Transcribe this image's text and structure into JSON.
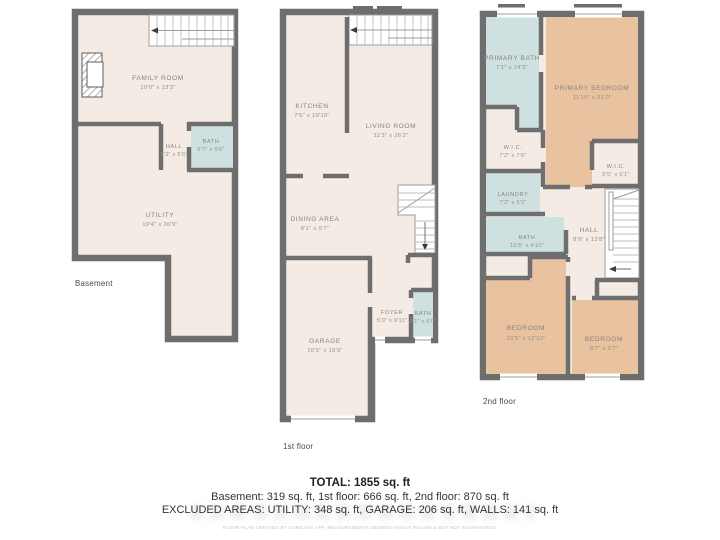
{
  "colors": {
    "walls": "#6e6e6e",
    "floor": "#f5ebe5",
    "wet_rooms": "#cfe0e0",
    "bedrooms": "#e9c2a0"
  },
  "floors": [
    {
      "name": "Basement",
      "rooms": [
        {
          "label": "FAMILY ROOM",
          "dims": "19'0\" x 13'3\""
        },
        {
          "label": "HALL",
          "dims": "5'3\" x 5'6\""
        },
        {
          "label": "BATH",
          "dims": "5'7\" x 5'6\""
        },
        {
          "label": "UTILITY",
          "dims": "19'4\" x 26'9\""
        }
      ]
    },
    {
      "name": "1st floor",
      "rooms": [
        {
          "label": "KITCHEN",
          "dims": "7'6\" x 19'10\""
        },
        {
          "label": "LIVING ROOM",
          "dims": "11'3\" x 26'2\""
        },
        {
          "label": "DINING AREA",
          "dims": "8'1\" x 9'7\""
        },
        {
          "label": "GARAGE",
          "dims": "10'5\" x 19'9\""
        },
        {
          "label": "FOYER",
          "dims": "5'0\" x 9'11\""
        },
        {
          "label": "BATH",
          "dims": "3'1\" x 6'0\""
        }
      ]
    },
    {
      "name": "2nd floor",
      "rooms": [
        {
          "label": "PRIMARY BATH",
          "dims": "7'1\" x 14'3\""
        },
        {
          "label": "PRIMARY BEDROOM",
          "dims": "11'10\" x 21'0\""
        },
        {
          "label": "W.I.C.",
          "dims": "7'2\" x 7'6\""
        },
        {
          "label": "W.I.C.",
          "dims": "5'5\" x 5'1\""
        },
        {
          "label": "LAUNDRY",
          "dims": "7'2\" x 5'2\""
        },
        {
          "label": "BATH",
          "dims": "10'5\" x 4'10\""
        },
        {
          "label": "HALL",
          "dims": "8'9\" x 13'8\""
        },
        {
          "label": "BEDROOM",
          "dims": "10'5\" x 12'10\""
        },
        {
          "label": "BEDROOM",
          "dims": "8'7\" x 9'7\""
        }
      ]
    }
  ],
  "summary": {
    "total_line": "TOTAL: 1855 sq. ft",
    "breakdown_line": "Basement: 319 sq. ft, 1st floor: 666 sq. ft, 2nd floor: 870 sq. ft",
    "excluded_line": "EXCLUDED AREAS: UTILITY: 348 sq. ft, GARAGE: 206 sq. ft, WALLS: 141 sq. ft",
    "fine_print": "FLOOR PLAN CREATED BY CUBICASA APP. MEASUREMENTS DEEMED HIGHLY RELIABLE BUT NOT GUARANTEED."
  }
}
